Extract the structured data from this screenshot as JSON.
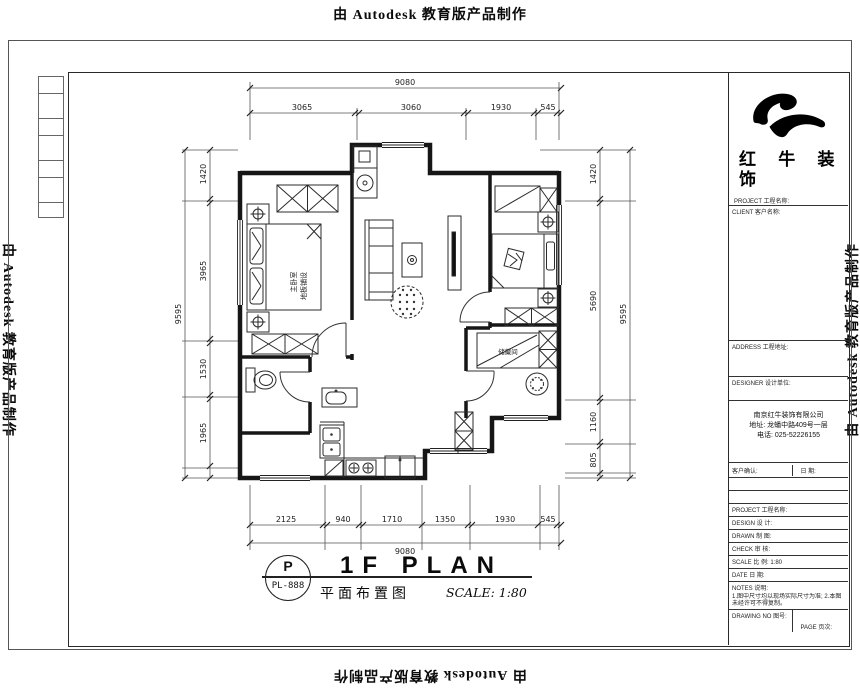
{
  "watermark": {
    "top": "由 Autodesk 教育版产品制作",
    "bottom": "由 Autodesk 教育版产品制作",
    "left": "由 Autodesk 教育版产品制作",
    "right": "由 Autodesk 教育版产品制作"
  },
  "plan": {
    "dims": {
      "top": {
        "overall": "9080",
        "segments": [
          "3065",
          "3060",
          "1930",
          "545"
        ]
      },
      "bottom": {
        "overall": "9080",
        "segments": [
          "2125",
          "940",
          "1710",
          "1350",
          "1930",
          "545"
        ]
      },
      "left": {
        "overall": "9595",
        "segments": [
          "1420",
          "3965",
          "1530",
          "1965"
        ]
      },
      "right": {
        "overall": "9595",
        "segments": [
          "1420",
          "5690",
          "1160",
          "805"
        ]
      }
    },
    "labels": {
      "master_bedroom": "主卧室",
      "master_bedroom_finish": "地板铺设",
      "storage": "储藏间"
    }
  },
  "titlebar": {
    "stamp_letter": "P",
    "stamp_code": "PL-888",
    "title": "1F PLAN",
    "subtitle": "平面布置图",
    "scale": "SCALE: 1:80"
  },
  "titleblock": {
    "brand_line1": "红 牛 装",
    "brand_line2": "饰",
    "section_project": "PROJECT 工程名称:",
    "section_client": "CLIENT 客户名称:",
    "section_address": "ADDRESS 工程地址:",
    "company_header": "DESIGNER 设计单位:",
    "company_name": "南京红牛装饰有限公司",
    "company_address": "地址: 龙蟠中路409号一层",
    "company_phone": "电话: 025-52226155",
    "confirm": "客户确认:",
    "confirm_date": "日 期:",
    "rows": [
      "PROJECT 工程名称:",
      "DESIGN 设 计:",
      "DRAWN 制 图:",
      "CHECK 审 核:",
      "SCALE 比 例: 1:80",
      "DATE 日 期:"
    ],
    "notes_title": "NOTES 说明:",
    "notes_body": "1.图中尺寸均以现场实际尺寸为准; 2.本图未经许可不得复制。",
    "drawing_no": "DRAWING NO 图号:",
    "page": "PAGE 页次:"
  }
}
